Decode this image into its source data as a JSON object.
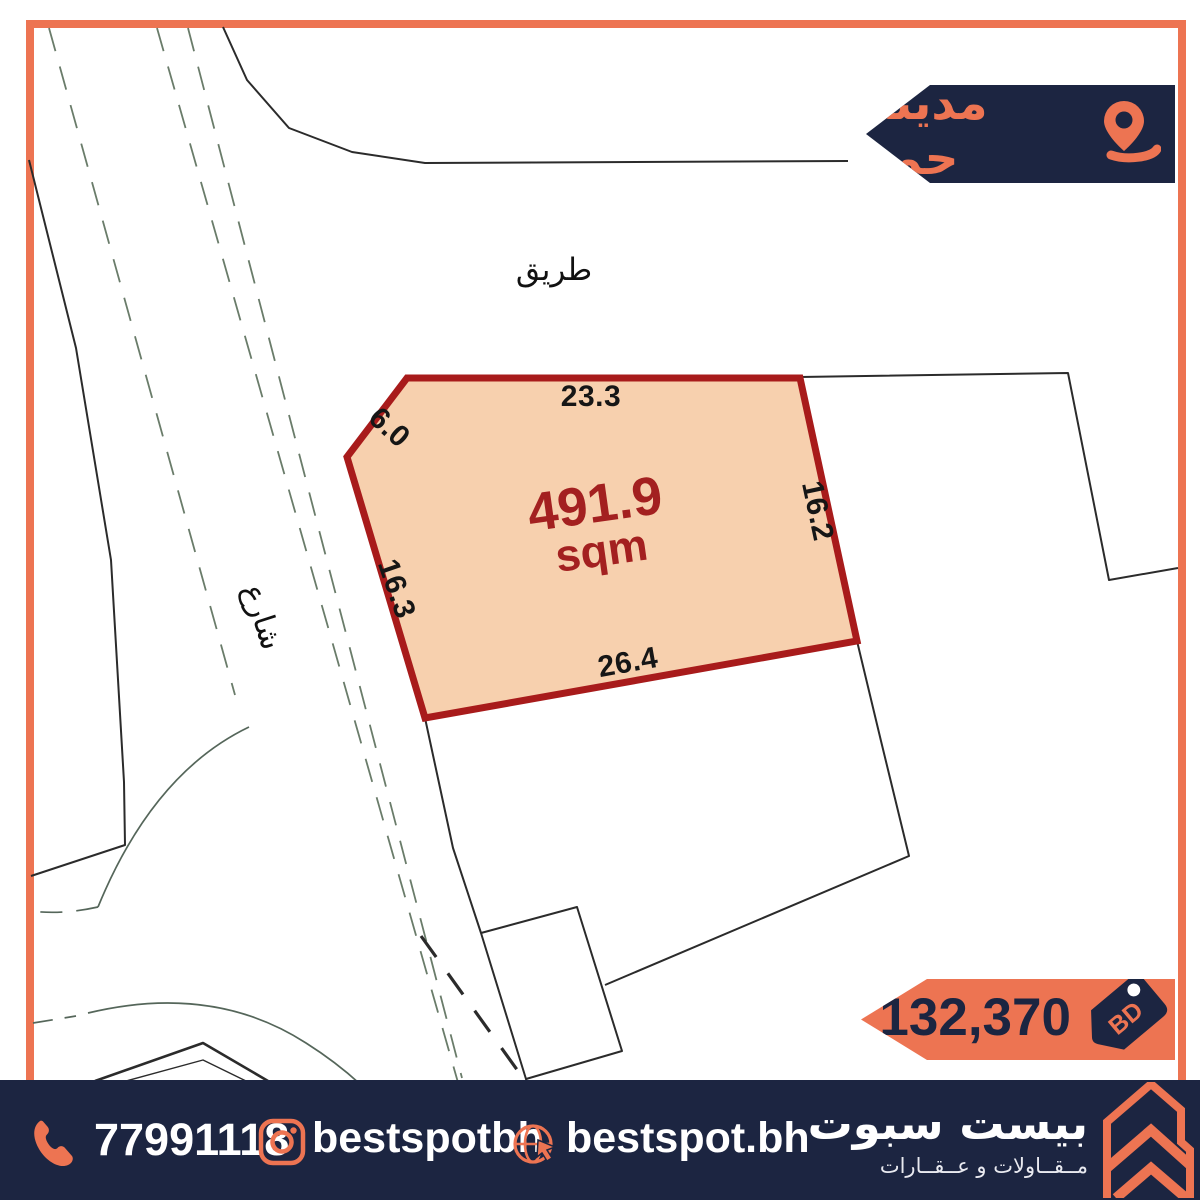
{
  "badge": {
    "location_label": "مدينة حمد"
  },
  "map": {
    "road_label": "طريق",
    "street_label": "شارع",
    "plot": {
      "area_value": "491.9",
      "area_unit": "sqm",
      "dim_top": "23.3",
      "dim_northwest": "6.0",
      "dim_west": "16.3",
      "dim_east": "16.2",
      "dim_south": "26.4"
    }
  },
  "price": {
    "amount": "132,370",
    "currency": "BD"
  },
  "footer": {
    "phone": "77991118",
    "instagram": "bestspotbh",
    "website": "bestspot.bh",
    "brand_name": "بيست سبوت",
    "brand_tagline": "مــقــاولات و عــقــارات"
  },
  "colors": {
    "accent_orange": "#ED7452",
    "navy": "#1C2541",
    "plot_border": "#A81B1B",
    "plot_fill": "#F7D0AE",
    "area_text": "#A32020"
  }
}
